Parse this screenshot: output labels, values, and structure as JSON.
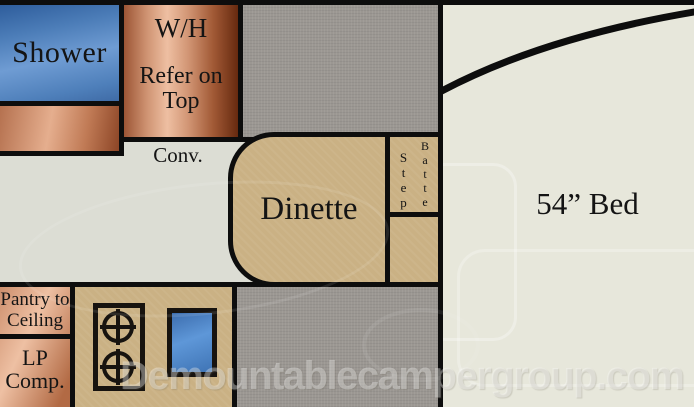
{
  "regions": {
    "shower": {
      "label": "Shower"
    },
    "water_heater": {
      "title": "W/H",
      "subtitle_line1": "Refer on",
      "subtitle_line2": "Top"
    },
    "conv": {
      "label": "Conv."
    },
    "dinette": {
      "label": "Dinette"
    },
    "step": {
      "label": "Step"
    },
    "battery": {
      "label": "Battery"
    },
    "bed": {
      "label": "54” Bed"
    },
    "pantry": {
      "line1": "Pantry to",
      "line2": "Ceiling"
    },
    "lp_compartment": {
      "line1": "LP",
      "line2": "Comp."
    }
  },
  "watermark": {
    "text": "Demountablecampergroup.com"
  },
  "icons": {
    "burner": "stove-burner-icon",
    "sink": "sink-basin"
  },
  "colors": {
    "wall_line": "#0d0d0d",
    "shower_blue": "#4e7fba",
    "sink_blue": "#4a86c8",
    "copper": "#cf9372",
    "tan": "#cab184",
    "cabinet_gray": "#9b9792",
    "floor": "#dcddd4",
    "bed_cream": "#e7e7db"
  }
}
